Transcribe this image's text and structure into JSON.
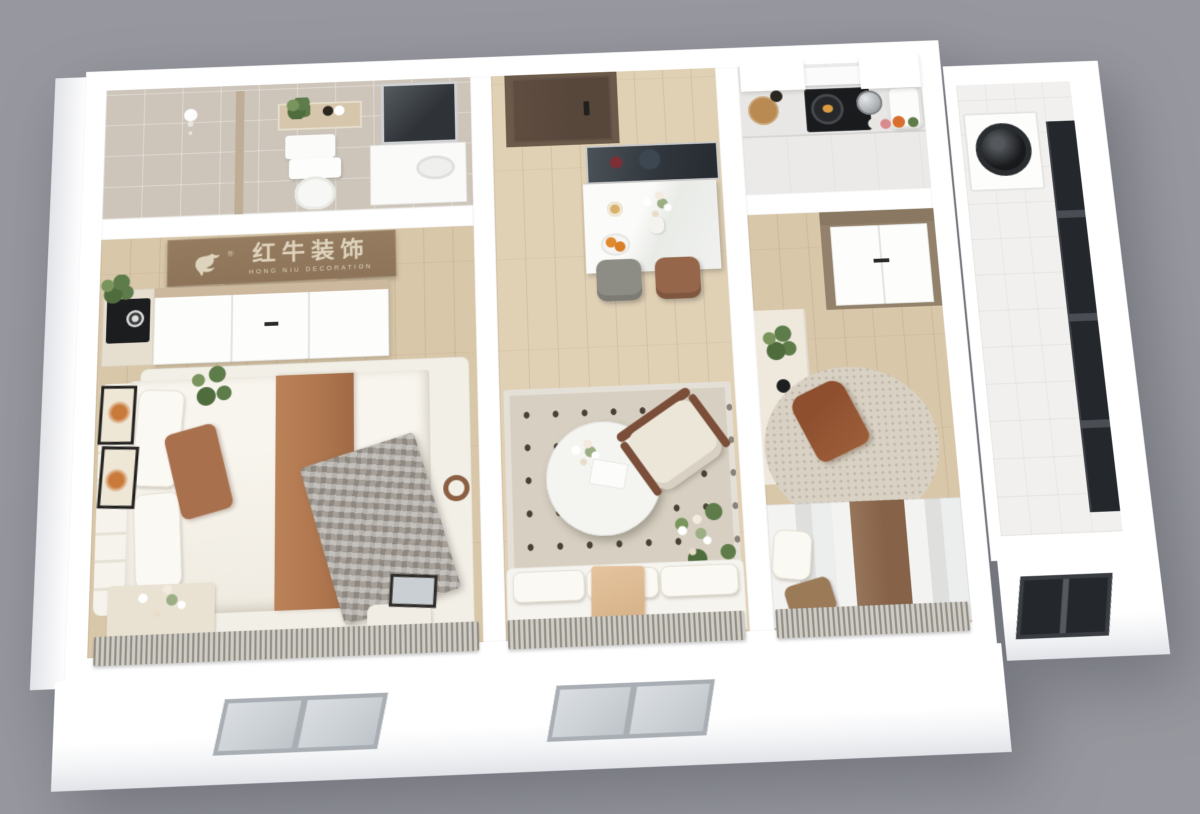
{
  "scene": {
    "description": "3D isometric cutaway render of a small apartment: bathroom and entry hall at top, kitchen and laundry balcony at right, master bedroom left, living-dining strip center, second bedroom right, exterior wall with two windows at bottom, gray studio background"
  },
  "logo": {
    "cn": "红牛装饰",
    "en": "HONG NIU DECORATION",
    "registered": "®"
  },
  "colors": {
    "bg": "#97989f",
    "wall": "#ffffff",
    "wallshade": "#e2e3e8",
    "wood": "#e0d0b4",
    "wood2": "#d9c7a9",
    "bath": "#cdc5ba",
    "kfloor": "#ebeae8",
    "wingfloor": "#f1f0ee",
    "rug": "#d7d0c2",
    "rugdot": "#4a4034",
    "rug1": "#f2efe7",
    "rug2": "#d9d2c4",
    "board": "#8d7459",
    "boardtext": "#ded3bc",
    "door": "#57463a",
    "doorframe": "#6b5a49",
    "tv": "#30363c",
    "marble": "#f1f2f0",
    "chairgray": "#8e8d85",
    "chairbrown": "#96664a",
    "rust": "#b0774f",
    "plaid": "#a59f98",
    "armwood": "#7a4e38",
    "green": "#5e7c4a",
    "desk": "#efe9dd",
    "chair2": "#9d5f3a",
    "wardrobe2": "#93816b",
    "counter": "#e8e7e5",
    "cooktop": "#1a1b1d",
    "glass": "#ccd1d5",
    "wframe": "#a8aeb3",
    "darkwin": "#24272c",
    "curtain": "#8f8d86",
    "curtain2": "#cfccc4",
    "blanket": "#d9b58c",
    "speaker": "#1c1d1f"
  }
}
